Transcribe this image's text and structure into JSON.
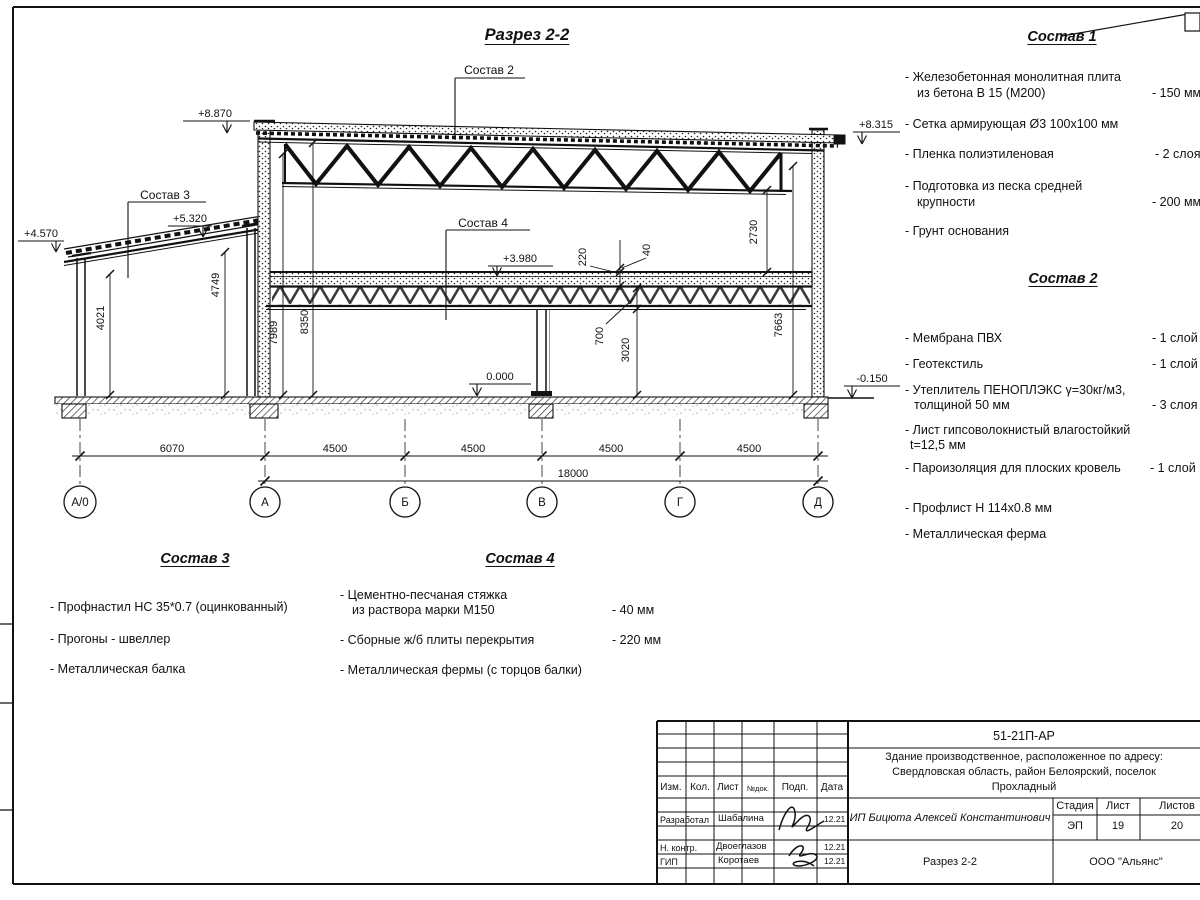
{
  "drawing": {
    "title": "Разрез 2-2",
    "leaders": {
      "sostav2": "Состав 2",
      "sostav3": "Состав 3",
      "sostav4": "Состав 4"
    },
    "elevations": {
      "roof_left": "+8.870",
      "roof_right": "+8.315",
      "annex_right": "+5.320",
      "annex_left": "+4.570",
      "floor2": "+3.980",
      "floor0": "0.000",
      "grade": "-0.150"
    },
    "dims": {
      "d6070": "6070",
      "d4500": "4500",
      "d18000": "18000",
      "d4021": "4021",
      "d4749": "4749",
      "d7989": "7989",
      "d8350": "8350",
      "d2730": "2730",
      "d7663": "7663",
      "d220": "220",
      "d40": "40",
      "d700": "700",
      "d3020": "3020"
    },
    "axes": [
      "А/0",
      "А",
      "Б",
      "В",
      "Г",
      "Д"
    ]
  },
  "sostav1": {
    "heading": "Состав 1",
    "lines": [
      {
        "t": "- Железобетонная  монолитная плита"
      },
      {
        "t": "из бетона В 15 (М200)",
        "v": "- 150 мм"
      },
      {
        "t": "- Сетка армирующая Ø3 100x100 мм"
      },
      {
        "t": "- Пленка полиэтиленовая",
        "v": "- 2 слоя"
      },
      {
        "t": "- Подготовка из песка средней"
      },
      {
        "t": "крупности",
        "v": "- 200 мм"
      },
      {
        "t": "- Грунт основания"
      }
    ]
  },
  "sostav2": {
    "heading": "Состав 2",
    "lines": [
      {
        "t": "- Мембрана ПВХ",
        "v": "- 1 слой"
      },
      {
        "t": "- Геотекстиль",
        "v": "- 1 слой"
      },
      {
        "t": "- Утеплитель ПЕНОПЛЭКС γ=30кг/м3,"
      },
      {
        "t": "толщиной 50 мм",
        "v": "- 3 слоя"
      },
      {
        "t": "- Лист гипсоволокнистый влагостойкий"
      },
      {
        "t": "t=12,5 мм"
      },
      {
        "t": "- Пароизоляция для плоских кровель",
        "v": "- 1 слой"
      },
      {
        "t": "- Профлист Н 114х0.8 мм"
      },
      {
        "t": "- Металлическая ферма"
      }
    ]
  },
  "sostav3": {
    "heading": "Состав 3",
    "lines": [
      {
        "t": "- Профнастил НС 35*0.7 (оцинкованный)"
      },
      {
        "t": "- Прогоны - швеллер"
      },
      {
        "t": "- Металлическая балка"
      }
    ]
  },
  "sostav4": {
    "heading": "Состав 4",
    "lines": [
      {
        "t": "- Цементно-песчаная стяжка"
      },
      {
        "t": "из раствора марки М150",
        "v": "- 40 мм"
      },
      {
        "t": "- Сборные ж/б плиты перекрытия",
        "v": "- 220 мм"
      },
      {
        "t": "- Металлическая фермы (с торцов балки)"
      }
    ]
  },
  "titleblock": {
    "code": "51-21П-АР",
    "object_line1": "Здание производственное, расположенное по адресу:",
    "object_line2": "Свердловская область, район Белоярский, поселок",
    "object_line3": "Прохладный",
    "designer_org": "ИП Бицюта Алексей Константинович",
    "cols": {
      "izm": "Изм.",
      "kol": "Кол.",
      "list": "Лист",
      "ndok": "№док.",
      "podp": "Подп.",
      "data": "Дата"
    },
    "stage_label": "Стадия",
    "sheet_label": "Лист",
    "sheets_label": "Листов",
    "stage": "ЭП",
    "sheet": "19",
    "sheets": "20",
    "rows": [
      {
        "role": "Разработал",
        "name": "Шабалина",
        "date": "12.21"
      },
      {
        "role": "Н. контр.",
        "name": "Двоеглазов",
        "date": "12.21"
      },
      {
        "role": "ГИП",
        "name": "Коротаев",
        "date": "12.21"
      }
    ],
    "view": "Разрез 2-2",
    "org": "ООО \"Альянс\""
  }
}
